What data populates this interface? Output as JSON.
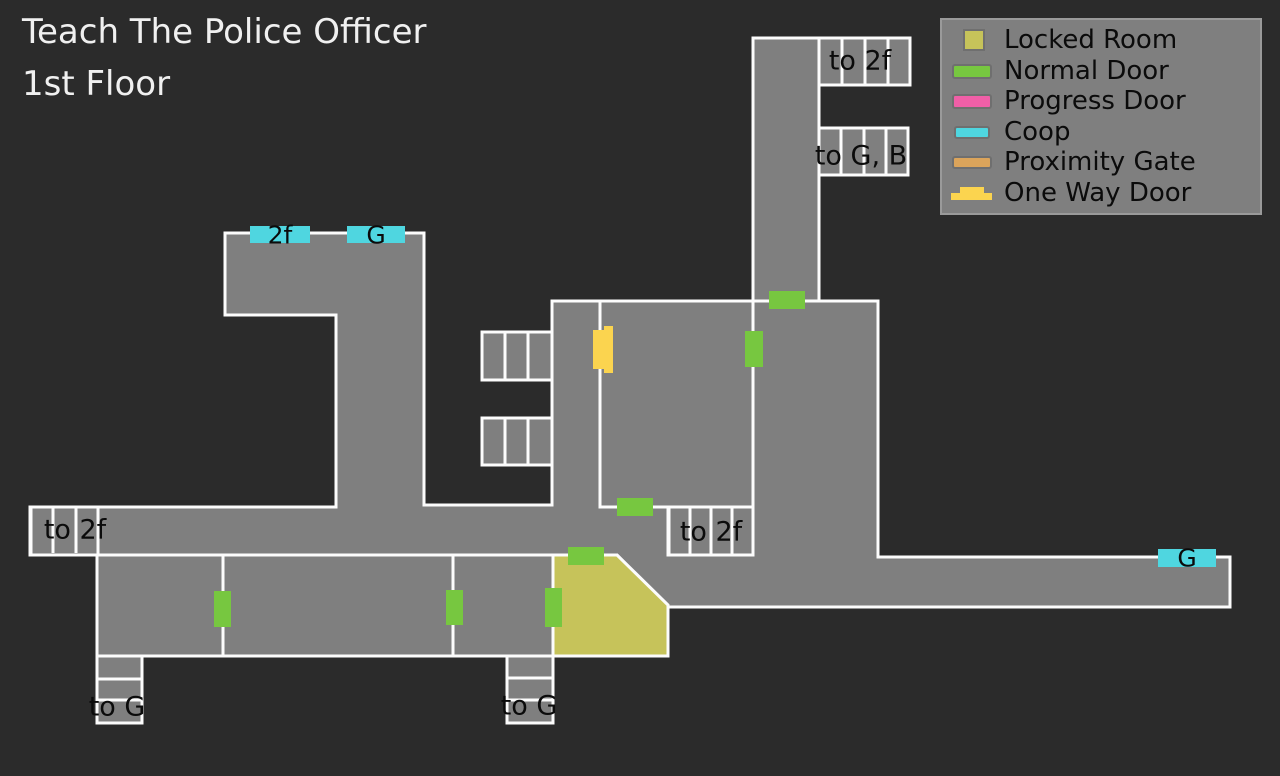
{
  "title": {
    "line1": "Teach The Police Officer",
    "line2": "1st Floor"
  },
  "legend": {
    "items": [
      {
        "label": "Locked Room",
        "color": "#c6c35a"
      },
      {
        "label": "Normal Door",
        "color": "#77c740"
      },
      {
        "label": "Progress Door",
        "color": "#f05fa7"
      },
      {
        "label": "Coop",
        "color": "#4fd6e0"
      },
      {
        "label": "Proximity Gate",
        "color": "#dba45b"
      },
      {
        "label": "One Way Door",
        "color": "#fbd44f"
      }
    ]
  },
  "map": {
    "colors": {
      "background": "#2b2b2b",
      "room_fill": "#7f7f7f",
      "wall": "#fcfcfc",
      "locked_room_fill": "#c6c35a",
      "normal_door": "#77c740",
      "coop": "#4fd6e0",
      "one_way_door": "#fbd44f",
      "label_text": "#0b0b0b",
      "title_text": "#f0f0f0"
    },
    "labels": {
      "top_stairs_up": "to 2f",
      "top_stairs_down": "to G, B",
      "coop_2f": "2f",
      "coop_g_top": "G",
      "coop_g_right": "G",
      "west_stairs": "to 2f",
      "center_stairs": "to 2f",
      "southwest_stairs": "to G",
      "south_stairs": "to G"
    }
  }
}
